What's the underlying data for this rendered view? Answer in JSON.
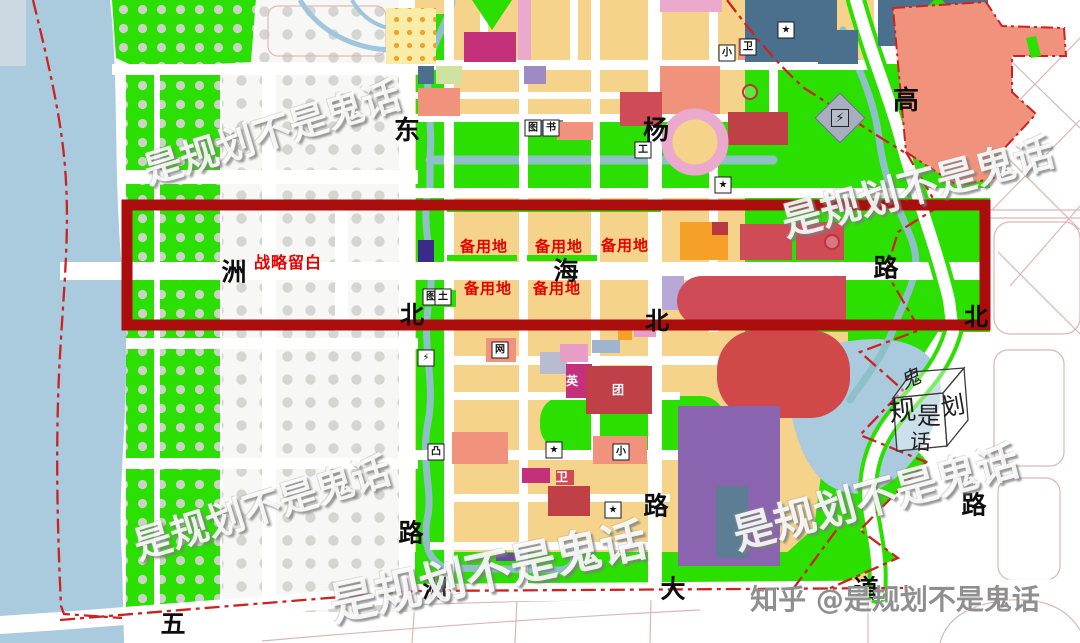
{
  "title": "urban-master-plan-zoning-map",
  "highlight": {
    "strategic_blank_label": "战略留白",
    "reserve_land_label": "备用地",
    "box_color": "#ab0c0c"
  },
  "red_labels": [
    {
      "t": "战略留白",
      "x": 288,
      "y": 263,
      "s": 16
    },
    {
      "t": "备用地",
      "x": 484,
      "y": 247,
      "s": 15
    },
    {
      "t": "备用地",
      "x": 559,
      "y": 247,
      "s": 15
    },
    {
      "t": "备用地",
      "x": 625,
      "y": 246,
      "s": 15
    },
    {
      "t": "备用地",
      "x": 488,
      "y": 289,
      "s": 15
    },
    {
      "t": "备用地",
      "x": 557,
      "y": 289,
      "s": 15
    }
  ],
  "road_labels": [
    {
      "t": "东",
      "x": 407,
      "y": 131,
      "s": 26
    },
    {
      "t": "杨",
      "x": 656,
      "y": 131,
      "s": 26
    },
    {
      "t": "高",
      "x": 906,
      "y": 101,
      "s": 26
    },
    {
      "t": "洲",
      "x": 234,
      "y": 272,
      "s": 25
    },
    {
      "t": "海",
      "x": 566,
      "y": 271,
      "s": 25
    },
    {
      "t": "路",
      "x": 886,
      "y": 268,
      "s": 25
    },
    {
      "t": "北",
      "x": 412,
      "y": 315,
      "s": 24
    },
    {
      "t": "北",
      "x": 657,
      "y": 321,
      "s": 24
    },
    {
      "t": "北",
      "x": 976,
      "y": 317,
      "s": 24
    },
    {
      "t": "路",
      "x": 411,
      "y": 533,
      "s": 25
    },
    {
      "t": "路",
      "x": 656,
      "y": 506,
      "s": 25
    },
    {
      "t": "路",
      "x": 974,
      "y": 505,
      "s": 25
    },
    {
      "t": "五",
      "x": 173,
      "y": 624,
      "s": 25
    },
    {
      "t": "洲",
      "x": 435,
      "y": 589,
      "s": 25
    },
    {
      "t": "大",
      "x": 673,
      "y": 589,
      "s": 25
    },
    {
      "t": "道",
      "x": 866,
      "y": 589,
      "s": 25
    }
  ],
  "watermarks": [
    {
      "t": "是规划不是鬼话",
      "x": 272,
      "y": 133,
      "rot": -17,
      "s": 38
    },
    {
      "t": "是规划不是鬼话",
      "x": 918,
      "y": 188,
      "rot": -15,
      "s": 40
    },
    {
      "t": "是规划不是鬼话",
      "x": 262,
      "y": 508,
      "rot": -17,
      "s": 38
    },
    {
      "t": "是规划不是鬼话",
      "x": 488,
      "y": 572,
      "rot": -12,
      "s": 46
    },
    {
      "t": "是规划不是鬼话",
      "x": 876,
      "y": 498,
      "rot": -15,
      "s": 42
    }
  ],
  "credit": {
    "text": "知乎 @是规划不是鬼话",
    "x": 895,
    "y": 600,
    "s": 28
  },
  "cube": {
    "chars": [
      "鬼",
      "规",
      "是",
      "划",
      "话"
    ]
  },
  "icons": [
    {
      "g": "★",
      "x": 786,
      "y": 30,
      "v": "box"
    },
    {
      "g": "小",
      "x": 727,
      "y": 53,
      "v": "box"
    },
    {
      "g": "卫",
      "x": 748,
      "y": 47,
      "v": "box"
    },
    {
      "g": "图",
      "x": 533,
      "y": 128,
      "v": "box"
    },
    {
      "g": "书",
      "x": 551,
      "y": 128,
      "v": "box"
    },
    {
      "g": "工",
      "x": 643,
      "y": 150,
      "v": "box"
    },
    {
      "g": "★",
      "x": 723,
      "y": 185,
      "v": "box"
    },
    {
      "g": "⚡",
      "x": 840,
      "y": 118,
      "v": "diamond"
    },
    {
      "g": "图",
      "x": 431,
      "y": 297,
      "v": "box"
    },
    {
      "g": "土",
      "x": 443,
      "y": 297,
      "v": "box"
    },
    {
      "g": "⚡",
      "x": 426,
      "y": 358,
      "v": "box"
    },
    {
      "g": "网",
      "x": 500,
      "y": 350,
      "v": "box"
    },
    {
      "g": "英",
      "x": 572,
      "y": 381,
      "v": "plainwhite"
    },
    {
      "g": "团",
      "x": 618,
      "y": 390,
      "v": "plainwhite"
    },
    {
      "g": "卫",
      "x": 562,
      "y": 477,
      "v": "plainwhite"
    },
    {
      "g": "凸",
      "x": 436,
      "y": 452,
      "v": "box"
    },
    {
      "g": "★",
      "x": 554,
      "y": 450,
      "v": "box"
    },
    {
      "g": "小",
      "x": 621,
      "y": 452,
      "v": "box"
    },
    {
      "g": "★",
      "x": 613,
      "y": 510,
      "v": "box"
    },
    {
      "g": "◎",
      "x": 750,
      "y": 92,
      "v": "ring"
    },
    {
      "g": "◎",
      "x": 832,
      "y": 242,
      "v": "ring"
    }
  ],
  "colors": {
    "water": "#a9cbdd",
    "park_green": "#2bdf00",
    "polka_dot": "#ccd2c6",
    "blank_dot": "#d5d5d1",
    "residential_yellow": "#f5d38a",
    "salmon": "#f0927c",
    "red_block": "#cf4b55",
    "dark_red_block": "#c04048",
    "magenta": "#c5307a",
    "pink": "#eba9cd",
    "purple": "#8b64b0",
    "slate_blue": "#4a708e",
    "canal": "#8fc0c8",
    "orange": "#f5a028",
    "highlight_box": "#ab0c0c",
    "boundary_line": "#cc2222",
    "label_red": "#e60000",
    "credit_gray": "#8f8f8f"
  }
}
